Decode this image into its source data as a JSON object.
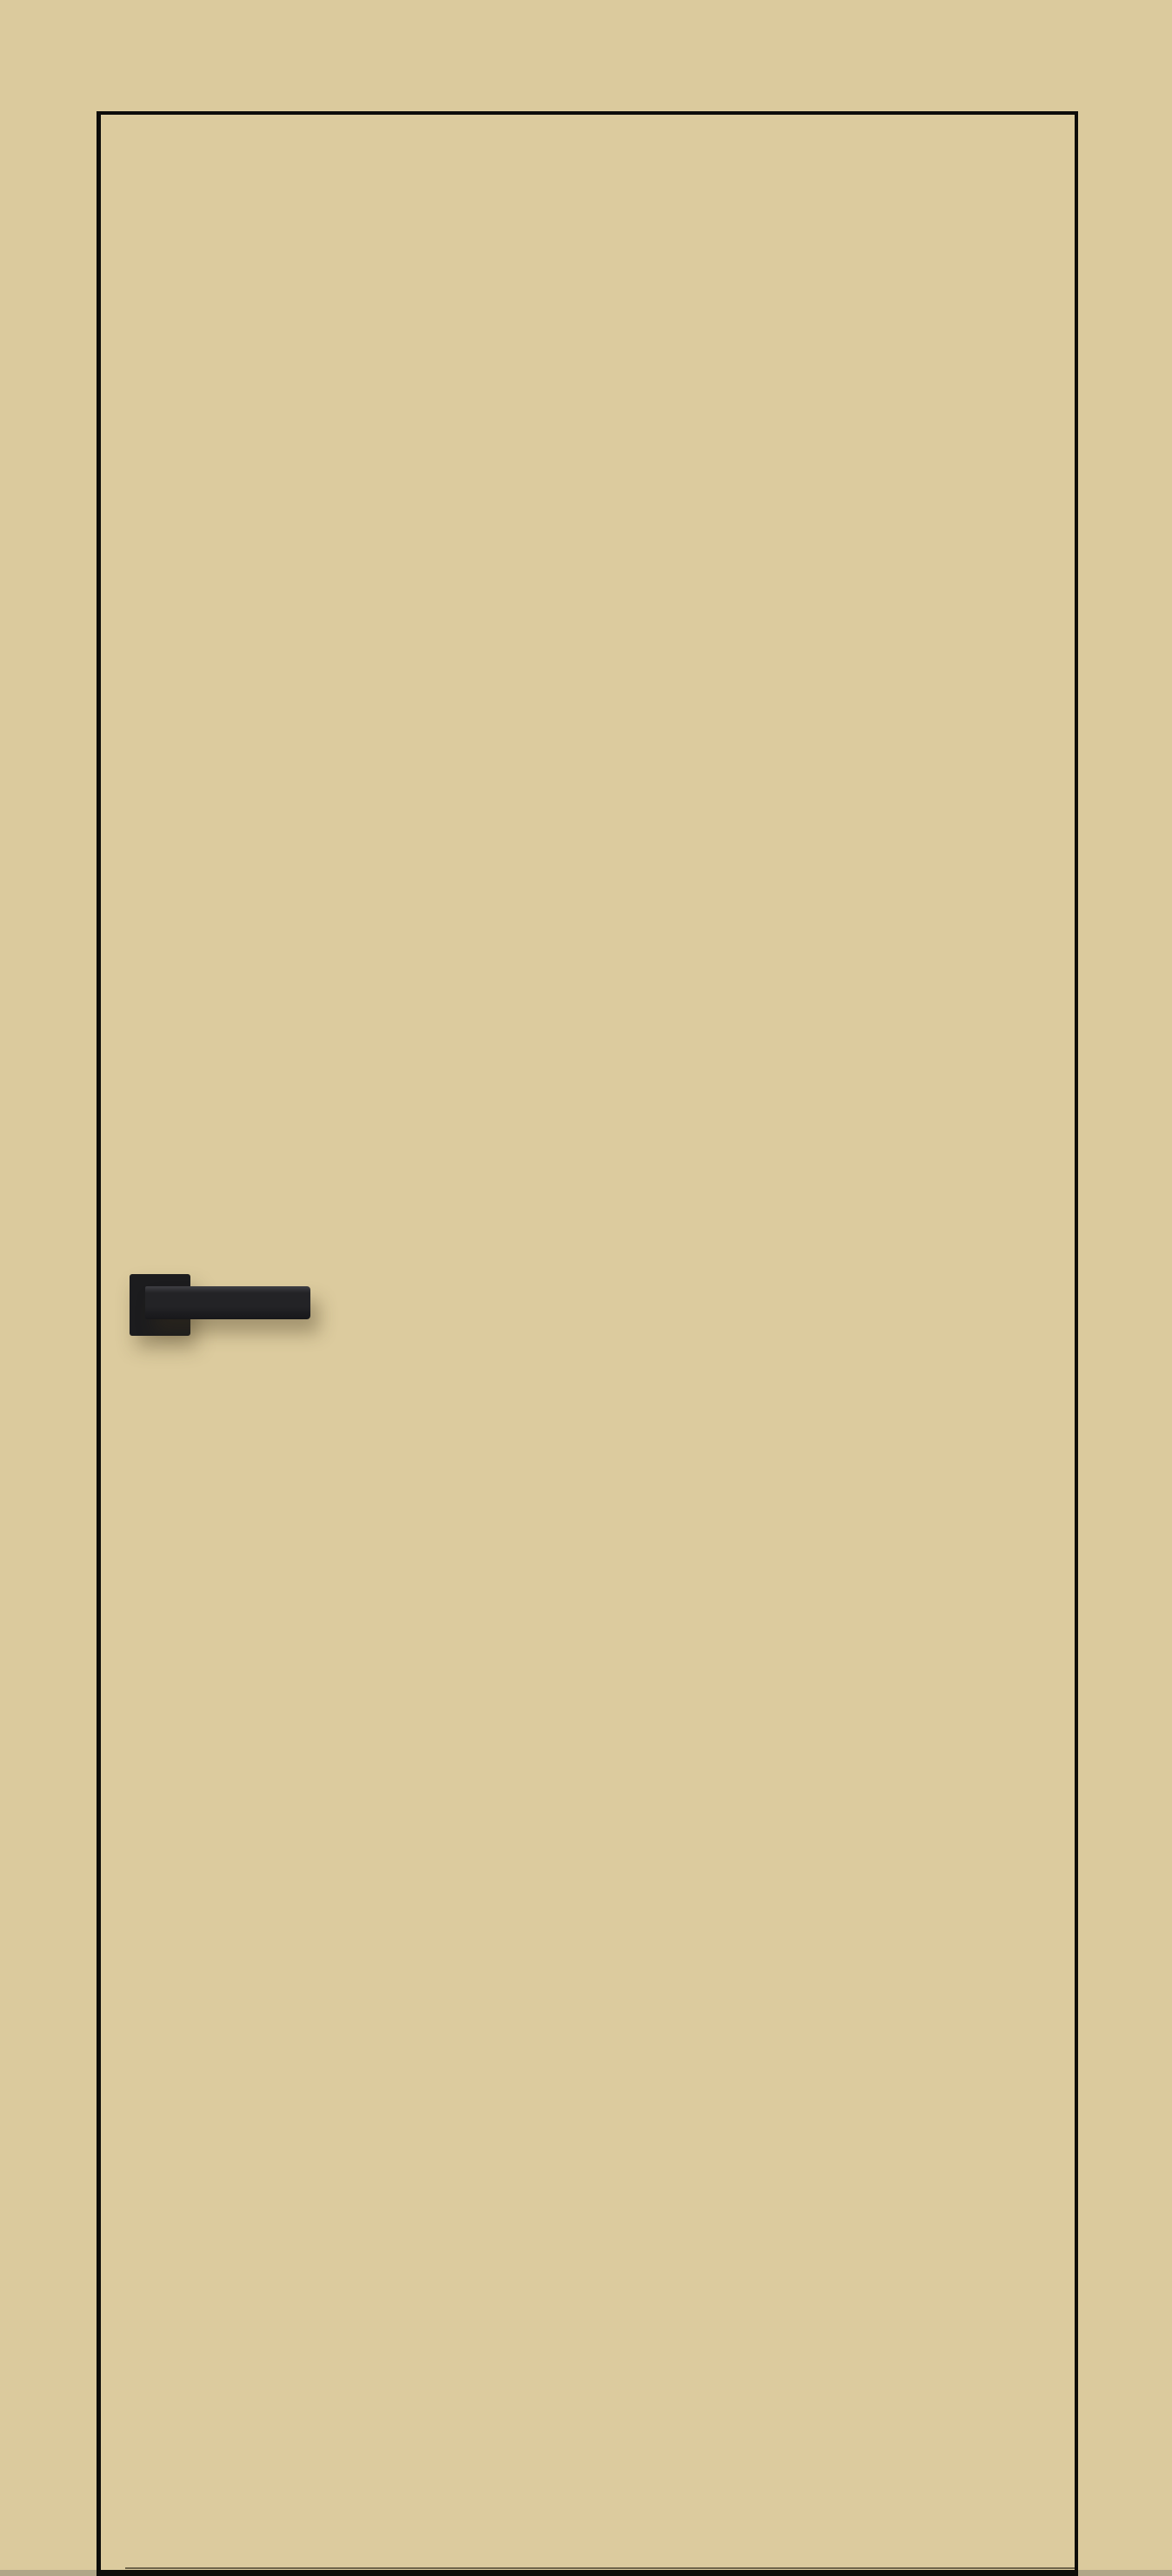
{
  "meta": {
    "description": "Product image of a beige flush interior door with black edge trim and a matte black square-rosette lever handle, shown against a matching beige background with a thin floor shadow at the bottom edge"
  },
  "scene": {
    "objects": [
      "door-panel",
      "door-edge-trim",
      "door-bottom-edge",
      "door-handle",
      "handle-rosette",
      "handle-lever",
      "floor-shadow"
    ],
    "door": {
      "style": "flush, no glazing, no panels",
      "finish": "beige matte",
      "edge": "thin black trim outline",
      "handle_type": "lever on square rosette",
      "handle_finish": "matte black",
      "handle_position": "left side, lever pointing right"
    }
  },
  "colors": {
    "background": "#dbca9d",
    "door_face": "#dccb9e",
    "edge_trim": "#0d0c0a",
    "handle_rosette": "#1c1c1e",
    "handle_lever": "#232326",
    "handle_lever_dark": "#17171a",
    "handle_highlight": "#3f3f44",
    "floor_shadow": "#9a927c",
    "handle_shadow": "rgba(60,50,25,0.35)"
  }
}
